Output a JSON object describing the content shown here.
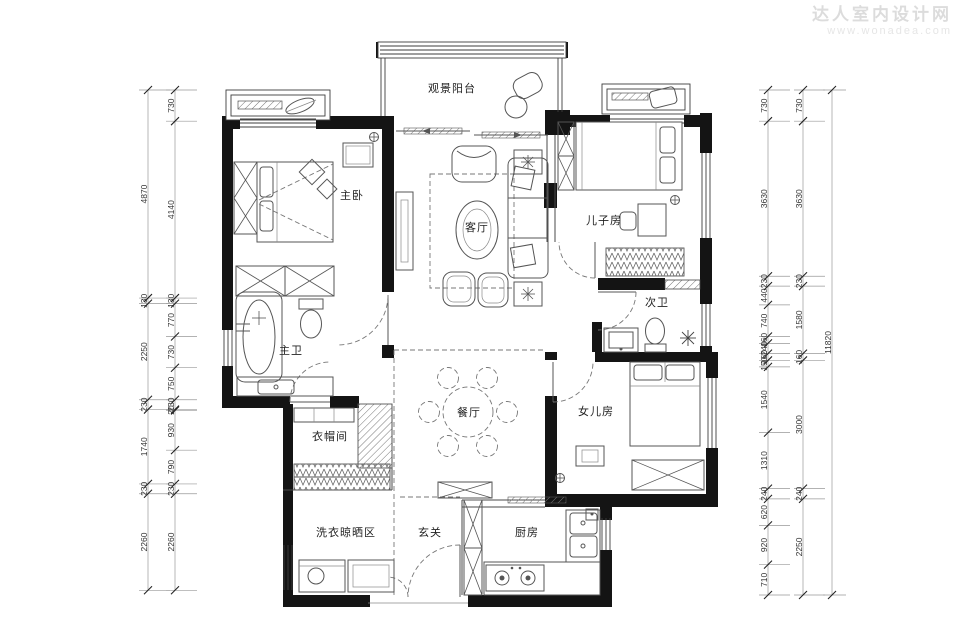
{
  "watermark": {
    "line1": "达人室内设计网",
    "line2": "www.wonadea.com"
  },
  "rooms": [
    {
      "id": "balcony",
      "label": "观景阳台",
      "x": 452,
      "y": 92
    },
    {
      "id": "master-bedroom",
      "label": "主卧",
      "x": 352,
      "y": 199
    },
    {
      "id": "living-room",
      "label": "客厅",
      "x": 477,
      "y": 231
    },
    {
      "id": "sons-room",
      "label": "儿子房",
      "x": 604,
      "y": 224
    },
    {
      "id": "second-bath",
      "label": "次卫",
      "x": 657,
      "y": 306
    },
    {
      "id": "master-bath",
      "label": "主卫",
      "x": 291,
      "y": 354
    },
    {
      "id": "daughters-room",
      "label": "女儿房",
      "x": 596,
      "y": 415
    },
    {
      "id": "closet",
      "label": "衣帽间",
      "x": 330,
      "y": 440
    },
    {
      "id": "dining-room",
      "label": "餐厅",
      "x": 469,
      "y": 416
    },
    {
      "id": "laundry",
      "label": "洗衣晾晒区",
      "x": 346,
      "y": 536
    },
    {
      "id": "foyer",
      "label": "玄关",
      "x": 430,
      "y": 536
    },
    {
      "id": "kitchen",
      "label": "厨房",
      "x": 527,
      "y": 536
    }
  ],
  "dimensions": {
    "left_outer": [
      4870,
      130,
      2250,
      230,
      1740,
      230,
      2260
    ],
    "left_inner": [
      730,
      4140,
      130,
      770,
      730,
      750,
      230,
      20,
      930,
      790,
      230,
      2260
    ],
    "right_inner": [
      730,
      3630,
      230,
      440,
      740,
      160,
      240,
      160,
      150,
      1540,
      1310,
      240,
      620,
      920,
      710
    ],
    "right_outer": [
      730,
      3630,
      230,
      1580,
      160,
      3000,
      240,
      2250
    ],
    "right_total": "11820"
  }
}
